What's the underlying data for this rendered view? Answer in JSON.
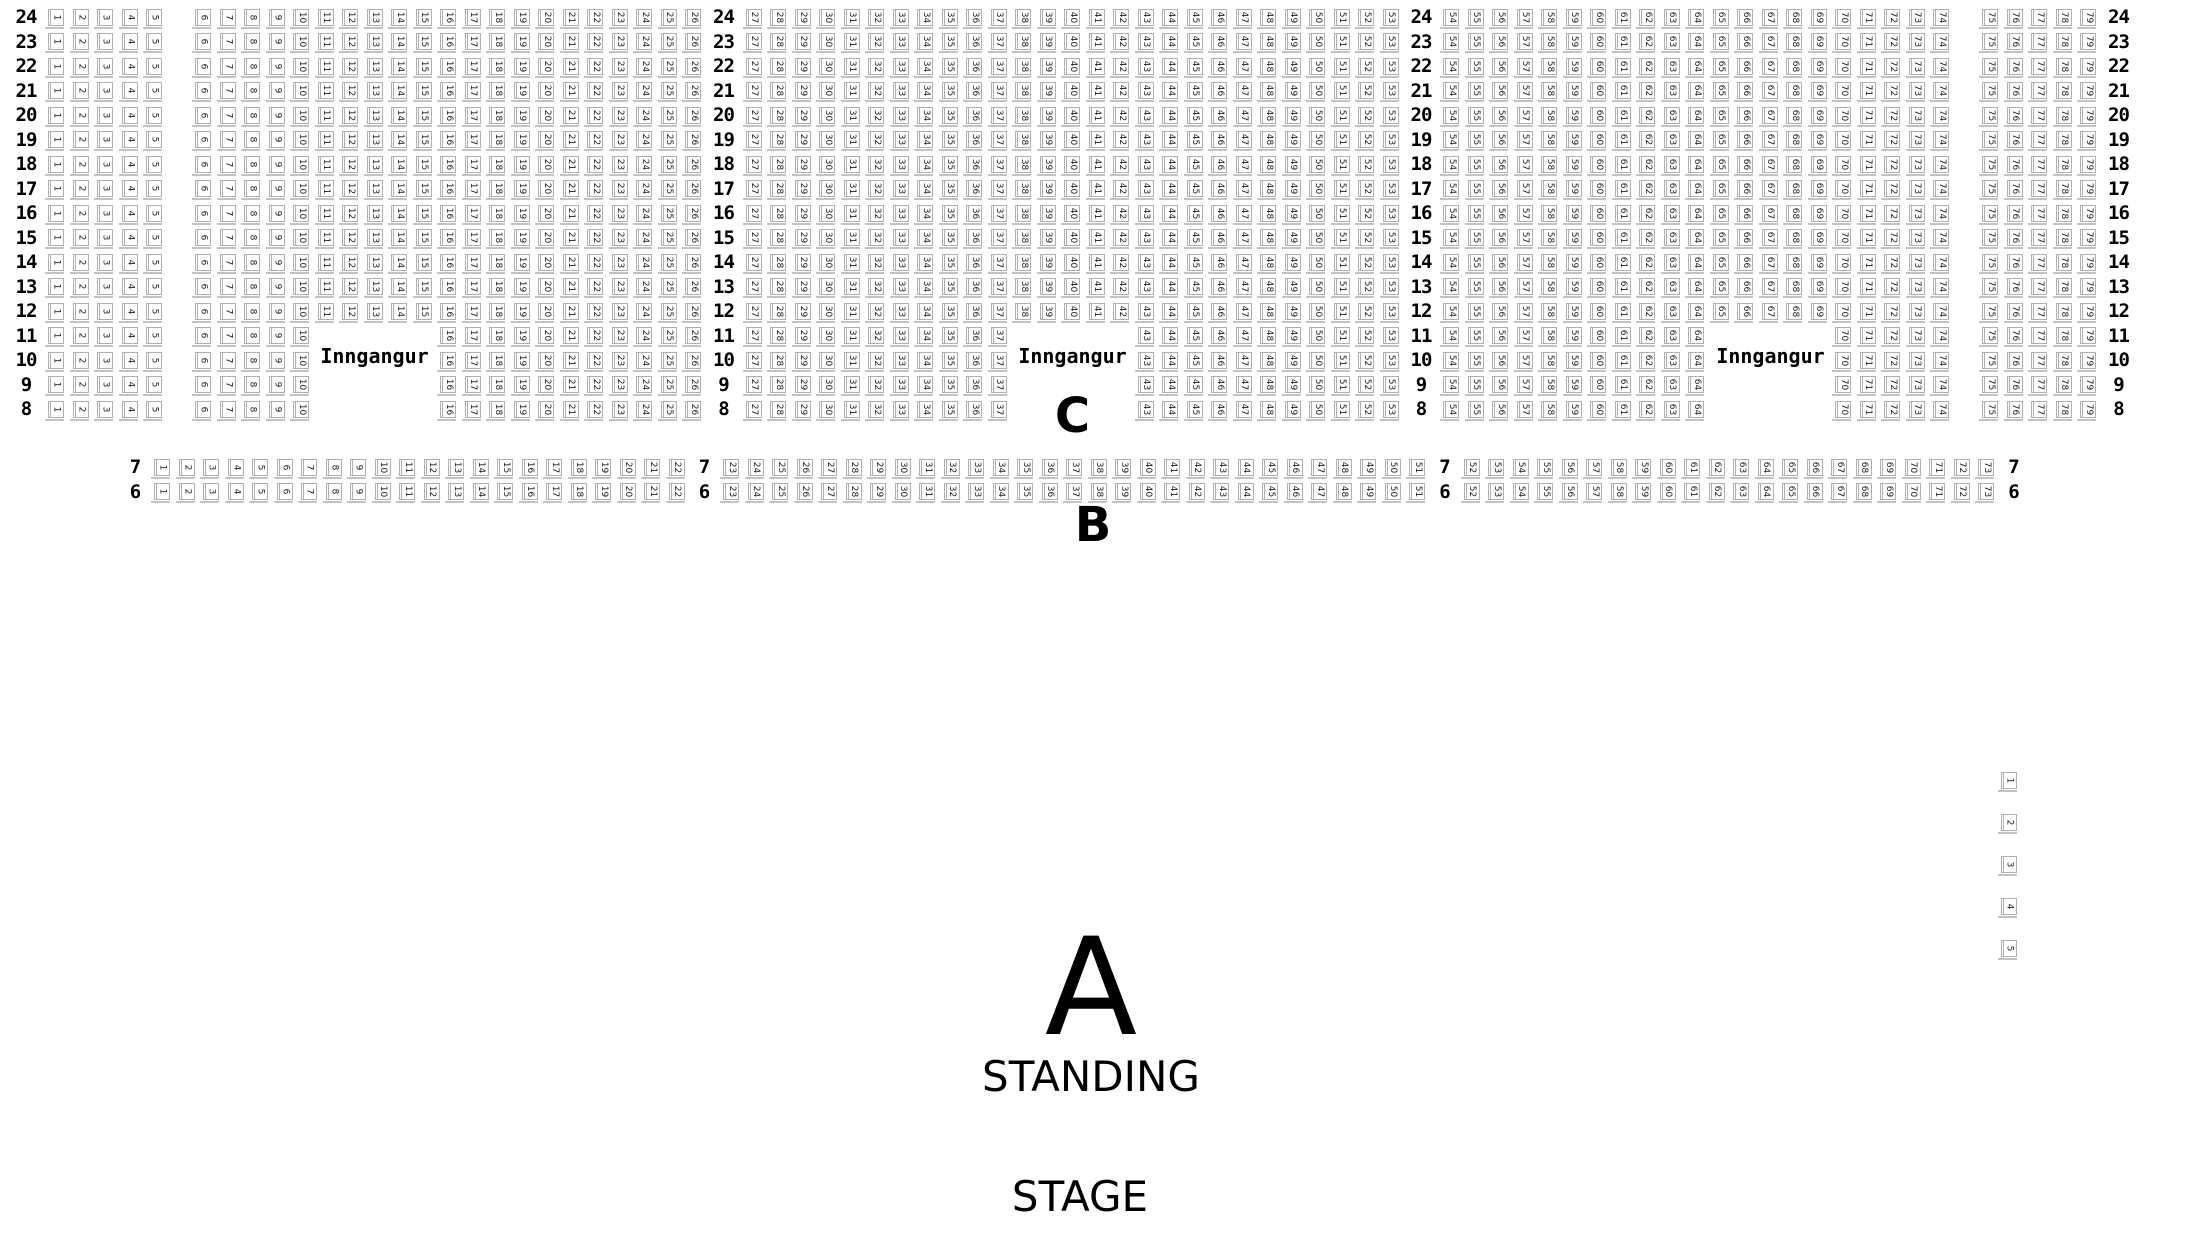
{
  "page": {
    "background": "#ffffff"
  },
  "labels": {
    "entrance": "Inngangur",
    "section_a_letter": "A",
    "section_b_letter": "B",
    "section_c_letter": "C",
    "standing": "STANDING",
    "stage": "STAGE"
  },
  "colors": {
    "seat_fill": "#ffffff",
    "seat_border": "#b0b0b0",
    "seat_shadow": "#c3c3c3",
    "seat_number": "#1c1c1c",
    "text": "#000000"
  },
  "seatmap": {
    "section_c": {
      "full_rows": [
        24,
        23,
        22,
        21,
        20,
        19,
        18,
        17,
        16,
        15,
        14,
        13,
        12
      ],
      "split_rows": [
        11,
        10,
        9,
        8
      ],
      "full_layout": [
        {
          "kind": "rowlabel"
        },
        {
          "kind": "seats",
          "from": 1,
          "to": 5
        },
        {
          "kind": "aisle"
        },
        {
          "kind": "seats",
          "from": 6,
          "to": 26
        },
        {
          "kind": "rowlabel"
        },
        {
          "kind": "seats",
          "from": 27,
          "to": 53
        },
        {
          "kind": "rowlabel"
        },
        {
          "kind": "seats",
          "from": 54,
          "to": 74
        },
        {
          "kind": "aisle"
        },
        {
          "kind": "seats",
          "from": 75,
          "to": 79
        },
        {
          "kind": "rowlabel"
        }
      ],
      "split_layout": [
        {
          "kind": "rowlabel"
        },
        {
          "kind": "seats",
          "from": 1,
          "to": 5
        },
        {
          "kind": "aisle"
        },
        {
          "kind": "seats",
          "from": 6,
          "to": 10
        },
        {
          "kind": "entrance_gap"
        },
        {
          "kind": "seats",
          "from": 16,
          "to": 26
        },
        {
          "kind": "rowlabel"
        },
        {
          "kind": "seats",
          "from": 27,
          "to": 37
        },
        {
          "kind": "entrance_gap"
        },
        {
          "kind": "seats",
          "from": 43,
          "to": 53
        },
        {
          "kind": "rowlabel"
        },
        {
          "kind": "seats",
          "from": 54,
          "to": 64
        },
        {
          "kind": "entrance_gap"
        },
        {
          "kind": "seats",
          "from": 70,
          "to": 74
        },
        {
          "kind": "aisle"
        },
        {
          "kind": "seats",
          "from": 75,
          "to": 79
        },
        {
          "kind": "rowlabel"
        }
      ]
    },
    "section_b": {
      "rows": [
        7,
        6
      ],
      "layout": [
        {
          "kind": "rowlabel"
        },
        {
          "kind": "seats",
          "from": 1,
          "to": 22
        },
        {
          "kind": "rowlabel"
        },
        {
          "kind": "seats",
          "from": 23,
          "to": 51
        },
        {
          "kind": "rowlabel"
        },
        {
          "kind": "seats",
          "from": 52,
          "to": 73
        },
        {
          "kind": "rowlabel"
        }
      ]
    },
    "side_seats": [
      1,
      2,
      3,
      4,
      5
    ]
  }
}
